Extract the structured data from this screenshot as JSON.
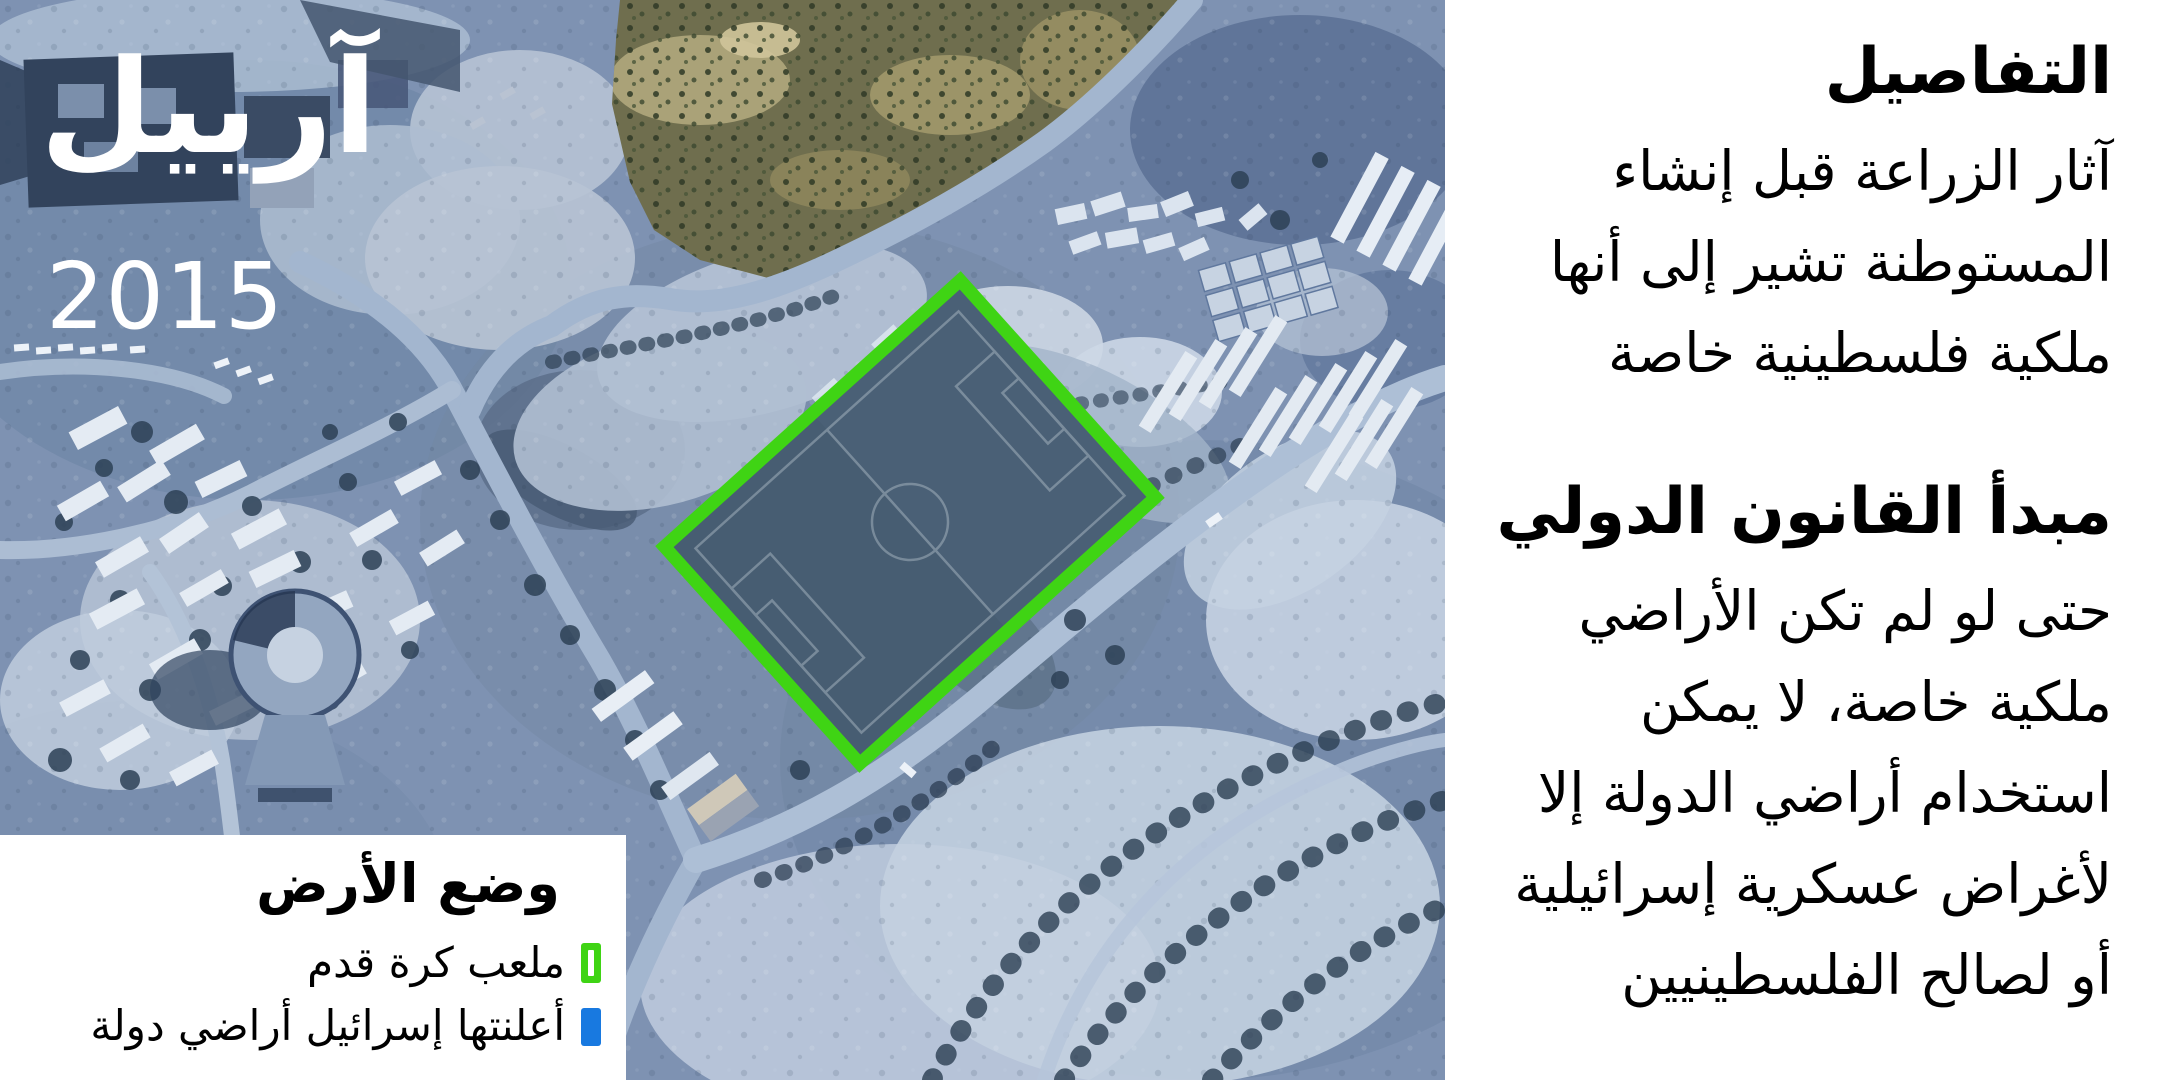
{
  "title_overlay": {
    "settlement_name": "آرييل",
    "year": "2015"
  },
  "legend": {
    "title": "وضع الأرض",
    "items": [
      {
        "label": "ملعب كرة قدم",
        "swatch_color": "#3fd414",
        "swatch": "field-outline-swatch"
      },
      {
        "label": "أعلنتها إسرائيل أراضي دولة",
        "swatch_color": "#1879e0",
        "swatch": "state-land-swatch"
      }
    ]
  },
  "details_panel": {
    "sections": [
      {
        "heading": "التفاصيل",
        "lines": [
          "آثار الزراعة قبل إنشاء",
          "المستوطنة تشير إلى أنها",
          "ملكية فلسطينية خاصة"
        ]
      },
      {
        "heading": "مبدأ القانون الدولي",
        "lines": [
          "حتى لو لم تكن الأراضي",
          "ملكية خاصة، لا يمكن",
          "استخدام أراضي الدولة إلا",
          "لأغراض عسكرية إسرائيلية",
          "أو لصالح الفلسطينيين"
        ]
      }
    ]
  },
  "colors": {
    "field_highlight_green": "#3fd414",
    "state_land_blue": "#1879e0",
    "panel_background": "#ffffff",
    "overlay_text": "#ffffff",
    "body_text": "#000000"
  }
}
